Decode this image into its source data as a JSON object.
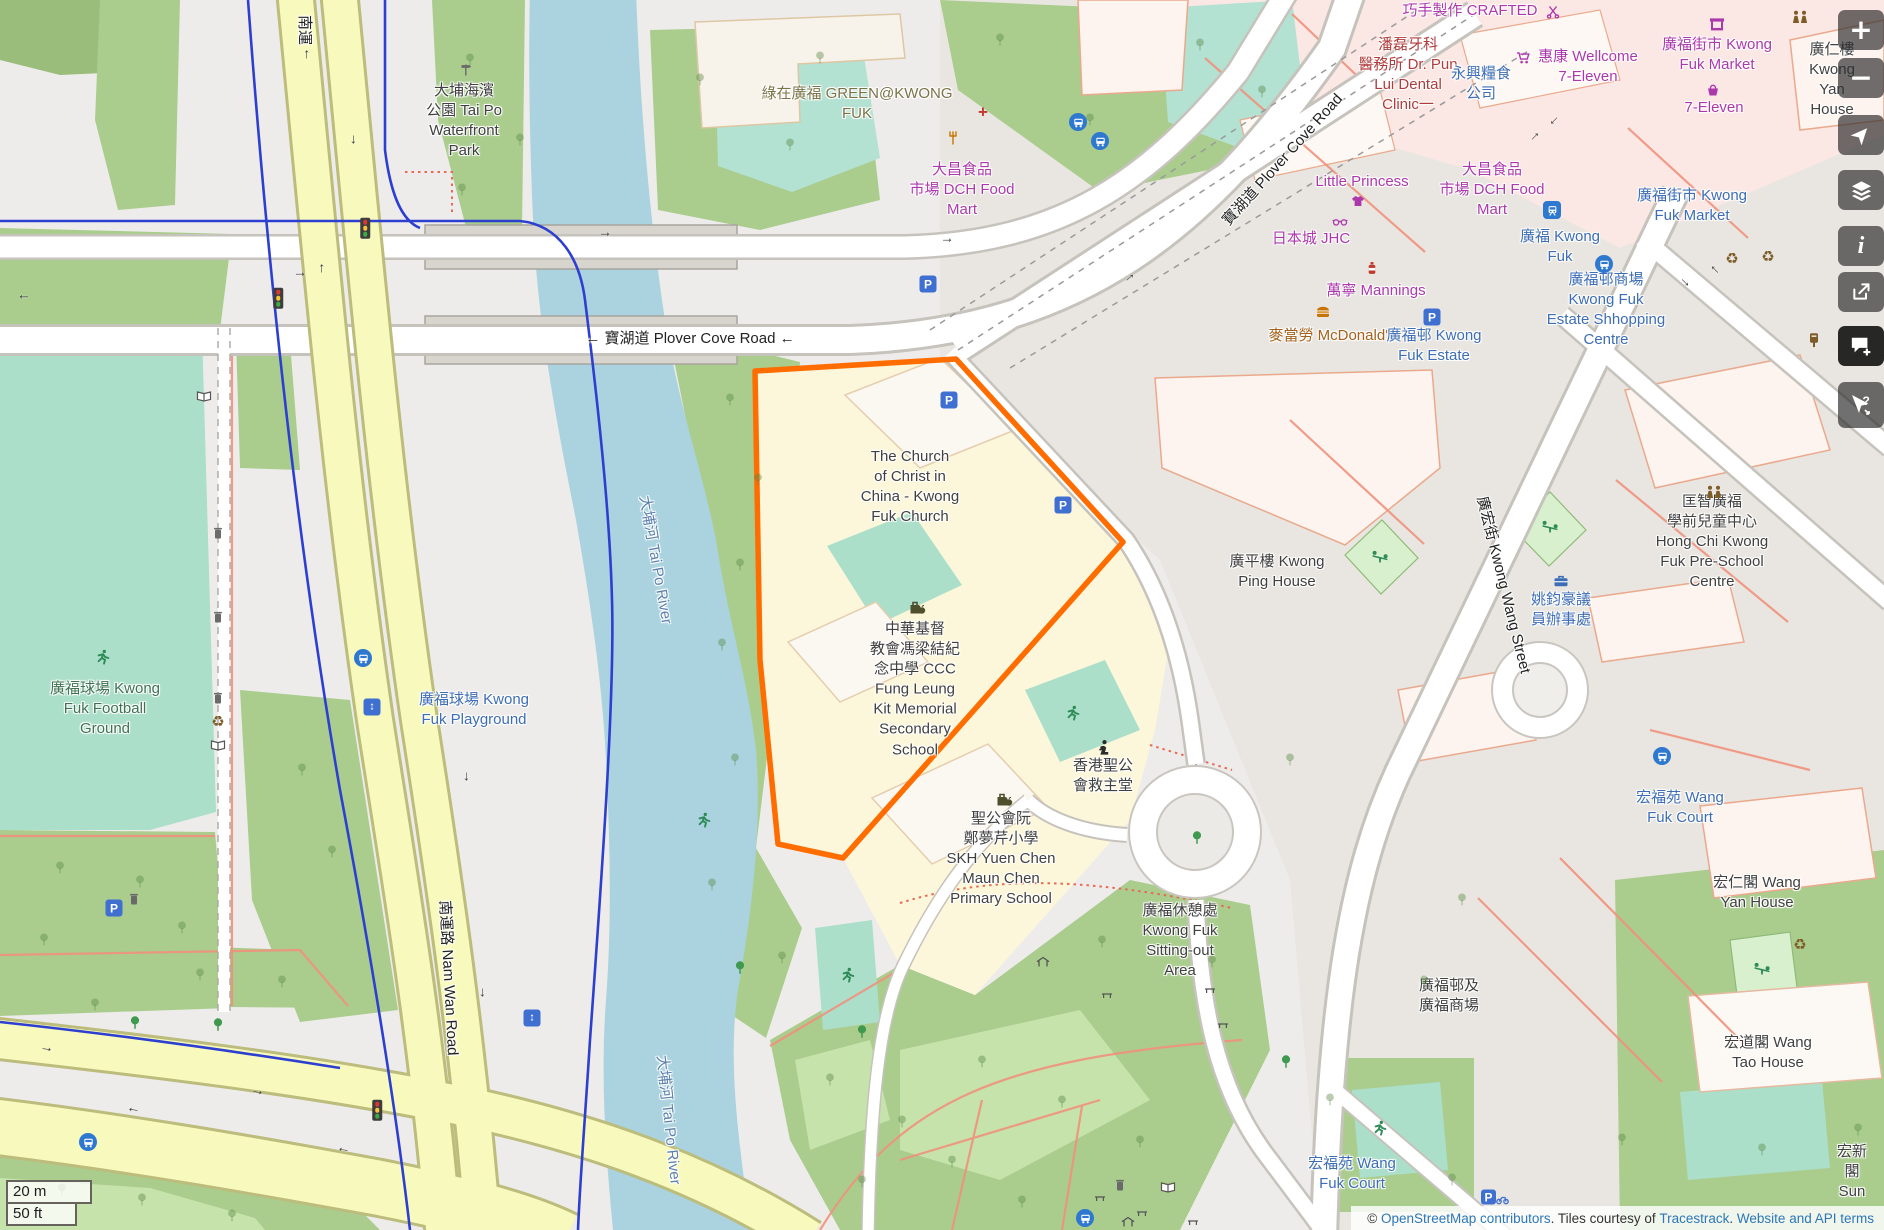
{
  "app": {
    "name": "OpenStreetMap style web map"
  },
  "palette": {
    "dark": "#404040",
    "black": "#222222",
    "blue": "#3d6db4",
    "magenta": "#ac39ac",
    "green": "#3f7252",
    "olive": "#7a7348",
    "red": "#b03c3c",
    "water": "#5d81ad",
    "food": "#a2621c"
  },
  "toolbar": {
    "buttons": [
      {
        "id": "zoom-in",
        "glyph": "+",
        "y": 10
      },
      {
        "id": "zoom-out",
        "glyph": "−",
        "y": 58
      },
      {
        "id": "locate",
        "y": 115
      },
      {
        "id": "layers",
        "y": 170
      },
      {
        "id": "info",
        "glyph": "i",
        "y": 226
      },
      {
        "id": "share",
        "y": 272
      },
      {
        "id": "add-note",
        "y": 326,
        "active": true
      },
      {
        "id": "query-features",
        "y": 382
      }
    ]
  },
  "scalebar": {
    "metric": "20 m",
    "imperial": "50 ft"
  },
  "attribution": {
    "parts": [
      {
        "text": "© ",
        "link": false
      },
      {
        "text": "OpenStreetMap contributors",
        "link": true
      },
      {
        "text": ". Tiles courtesy of ",
        "link": false
      },
      {
        "text": "Tracestrack",
        "link": true
      },
      {
        "text": ". ",
        "link": false
      },
      {
        "text": "Website and API terms",
        "link": true
      }
    ]
  },
  "map": {
    "highlight_color": "#ff6d00",
    "labels": [
      {
        "t": "南運",
        "x": 304,
        "y": 30,
        "c": "black",
        "r": 90
      },
      {
        "t": "大埔海濱\n公園 Tai Po\nWaterfront\nPark",
        "x": 464,
        "y": 121
      },
      {
        "t": "綠在廣福 GREEN@KWONG\nFUK",
        "x": 857,
        "y": 104,
        "c": "olive"
      },
      {
        "t": "← 寶湖道 Plover Cove Road ←",
        "x": 690,
        "y": 339,
        "c": "black"
      },
      {
        "t": "寶湖道 Plover Cove Road",
        "x": 1283,
        "y": 160,
        "c": "black",
        "r": -48
      },
      {
        "t": "大埔河 Tai Po River",
        "x": 655,
        "y": 560,
        "c": "water",
        "r": 80
      },
      {
        "t": "大埔河 Tai Po River",
        "x": 668,
        "y": 1120,
        "c": "water",
        "r": 84
      },
      {
        "t": "廣福球場 Kwong\nFuk Football\nGround",
        "x": 105,
        "y": 709,
        "c": "green"
      },
      {
        "t": "廣福球場 Kwong\nFuk Playground",
        "x": 474,
        "y": 710,
        "c": "blue"
      },
      {
        "t": "南運路 Nam Wan Road",
        "x": 448,
        "y": 978,
        "c": "black",
        "r": 87
      },
      {
        "t": "The Church\nof Christ in\nChina - Kwong\nFuk Church",
        "x": 910,
        "y": 487
      },
      {
        "t": "中華基督\n教會馮梁結紀\n念中學 CCC\nFung Leung\nKit Memorial\nSecondary\nSchool",
        "x": 915,
        "y": 690
      },
      {
        "t": "聖公會阮\n鄭夢芹小學\nSKH Yuen Chen\nMaun Chen\nPrimary School",
        "x": 1001,
        "y": 859
      },
      {
        "t": "香港聖公\n會救主堂",
        "x": 1103,
        "y": 776
      },
      {
        "t": "廣福休憩處\nKwong Fuk\nSitting-out\nArea",
        "x": 1180,
        "y": 941
      },
      {
        "t": "廣平樓 Kwong\nPing House",
        "x": 1277,
        "y": 572
      },
      {
        "t": "匡智廣福\n學前兒童中心\nHong Chi Kwong\nFuk Pre-School\nCentre",
        "x": 1712,
        "y": 542
      },
      {
        "t": "姚鈞豪議\n員辦事處",
        "x": 1561,
        "y": 610,
        "c": "blue"
      },
      {
        "t": "廣宏街 Kwong Wang Street",
        "x": 1503,
        "y": 585,
        "c": "black",
        "r": 76
      },
      {
        "t": "宏福苑 Wang\nFuk Court",
        "x": 1680,
        "y": 808,
        "c": "blue"
      },
      {
        "t": "宏仁閣 Wang\nYan House",
        "x": 1757,
        "y": 893
      },
      {
        "t": "宏道閣 Wang\nTao House",
        "x": 1768,
        "y": 1053
      },
      {
        "t": "宏福苑 Wang\nFuk Court",
        "x": 1352,
        "y": 1174,
        "c": "blue"
      },
      {
        "t": "宏新閣\nSun",
        "x": 1852,
        "y": 1172
      },
      {
        "t": "廣福街市 Kwong\nFuk Market",
        "x": 1717,
        "y": 55,
        "c": "magenta"
      },
      {
        "t": "廣仁樓 Kwong\nYan House",
        "x": 1832,
        "y": 80
      },
      {
        "t": "惠康 Wellcome\n7-Eleven",
        "x": 1588,
        "y": 67,
        "c": "magenta"
      },
      {
        "t": "7-Eleven",
        "x": 1714,
        "y": 108,
        "c": "magenta"
      },
      {
        "t": "巧手製作 CRAFTED",
        "x": 1470,
        "y": 11,
        "c": "magenta"
      },
      {
        "t": "潘磊牙科\n醫務所 Dr. Pun\nLui Dental\nClinic一",
        "x": 1408,
        "y": 75,
        "c": "red"
      },
      {
        "t": "永興糧食\n公司",
        "x": 1481,
        "y": 84,
        "c": "blue"
      },
      {
        "t": "Little Princess",
        "x": 1362,
        "y": 182,
        "c": "magenta"
      },
      {
        "t": "日本城 JHC",
        "x": 1311,
        "y": 239,
        "c": "magenta"
      },
      {
        "t": "大昌食品\n市場 DCH Food\nMart",
        "x": 962,
        "y": 190,
        "c": "magenta"
      },
      {
        "t": "大昌食品\n市場 DCH Food\nMart",
        "x": 1492,
        "y": 190,
        "c": "magenta"
      },
      {
        "t": "萬寧 Mannings",
        "x": 1376,
        "y": 291,
        "c": "magenta"
      },
      {
        "t": "麥當勞 McDonald's",
        "x": 1332,
        "y": 336,
        "c": "food"
      },
      {
        "t": "廣福邨 Kwong\nFuk Estate",
        "x": 1434,
        "y": 346,
        "c": "blue"
      },
      {
        "t": "廣福街市 Kwong\nFuk Market",
        "x": 1692,
        "y": 206,
        "c": "blue"
      },
      {
        "t": "廣福 Kwong\nFuk",
        "x": 1560,
        "y": 247,
        "c": "blue"
      },
      {
        "t": "廣福邨商場\nKwong Fuk\nEstate Shhopping\nCentre",
        "x": 1606,
        "y": 310,
        "c": "blue"
      },
      {
        "t": "廣福邨及\n廣福商場",
        "x": 1449,
        "y": 996
      }
    ],
    "icons": [
      {
        "k": "parking",
        "x": 949,
        "y": 400
      },
      {
        "k": "parking",
        "x": 1063,
        "y": 505
      },
      {
        "k": "parking",
        "x": 1432,
        "y": 317
      },
      {
        "k": "parking",
        "x": 928,
        "y": 284
      },
      {
        "k": "parking",
        "x": 114,
        "y": 908
      },
      {
        "k": "parkingbike",
        "x": 1495,
        "y": 1197
      },
      {
        "k": "bus",
        "x": 1078,
        "y": 122
      },
      {
        "k": "bus",
        "x": 1100,
        "y": 141
      },
      {
        "k": "bus",
        "x": 363,
        "y": 658
      },
      {
        "k": "bus",
        "x": 88,
        "y": 1142
      },
      {
        "k": "bus",
        "x": 1085,
        "y": 1218
      },
      {
        "k": "bus",
        "x": 1662,
        "y": 756
      },
      {
        "k": "bus",
        "x": 1604,
        "y": 264
      },
      {
        "k": "rail",
        "x": 1552,
        "y": 210
      },
      {
        "k": "elevator",
        "x": 372,
        "y": 707
      },
      {
        "k": "elevator",
        "x": 532,
        "y": 1018
      },
      {
        "k": "trafficlight",
        "x": 365,
        "y": 228
      },
      {
        "k": "trafficlight",
        "x": 278,
        "y": 298
      },
      {
        "k": "trafficlight",
        "x": 377,
        "y": 1110
      },
      {
        "k": "school",
        "x": 917,
        "y": 607
      },
      {
        "k": "school",
        "x": 1004,
        "y": 799
      },
      {
        "k": "worship",
        "x": 1103,
        "y": 748
      },
      {
        "k": "runner",
        "x": 103,
        "y": 657
      },
      {
        "k": "runner",
        "x": 1073,
        "y": 713
      },
      {
        "k": "runner",
        "x": 704,
        "y": 820
      },
      {
        "k": "runner",
        "x": 848,
        "y": 975
      },
      {
        "k": "runner",
        "x": 1380,
        "y": 1128
      },
      {
        "k": "seesaw",
        "x": 1380,
        "y": 556
      },
      {
        "k": "seesaw",
        "x": 1550,
        "y": 526
      },
      {
        "k": "seesaw",
        "x": 1762,
        "y": 968
      },
      {
        "k": "people",
        "x": 1800,
        "y": 17
      },
      {
        "k": "people",
        "x": 1714,
        "y": 492
      },
      {
        "k": "recycle",
        "x": 218,
        "y": 722
      },
      {
        "k": "recycle",
        "x": 1732,
        "y": 259
      },
      {
        "k": "recycle",
        "x": 1768,
        "y": 257
      },
      {
        "k": "recycle",
        "x": 1800,
        "y": 945
      },
      {
        "k": "postbox",
        "x": 1814,
        "y": 340
      },
      {
        "k": "trash",
        "x": 218,
        "y": 533
      },
      {
        "k": "trash",
        "x": 218,
        "y": 617
      },
      {
        "k": "trash",
        "x": 218,
        "y": 698
      },
      {
        "k": "trash",
        "x": 134,
        "y": 899
      },
      {
        "k": "trash",
        "x": 1120,
        "y": 1185
      },
      {
        "k": "mapboard",
        "x": 218,
        "y": 745
      },
      {
        "k": "mapboard",
        "x": 204,
        "y": 396
      },
      {
        "k": "mapboard",
        "x": 1168,
        "y": 1187
      },
      {
        "k": "burger",
        "x": 1323,
        "y": 312
      },
      {
        "k": "fork",
        "x": 953,
        "y": 138
      },
      {
        "k": "medical",
        "x": 983,
        "y": 112
      },
      {
        "k": "bottle",
        "x": 1372,
        "y": 268
      },
      {
        "k": "stall",
        "x": 1717,
        "y": 24
      },
      {
        "k": "basket",
        "x": 1713,
        "y": 90
      },
      {
        "k": "cart",
        "x": 1523,
        "y": 58
      },
      {
        "k": "scissors",
        "x": 1553,
        "y": 12
      },
      {
        "k": "briefcase",
        "x": 1561,
        "y": 581
      },
      {
        "k": "shelter",
        "x": 1043,
        "y": 962
      },
      {
        "k": "shelter",
        "x": 1128,
        "y": 1222
      },
      {
        "k": "bench",
        "x": 1107,
        "y": 995
      },
      {
        "k": "bench",
        "x": 1210,
        "y": 990
      },
      {
        "k": "bench",
        "x": 1223,
        "y": 1025
      },
      {
        "k": "bench",
        "x": 1100,
        "y": 1198
      },
      {
        "k": "bench",
        "x": 1142,
        "y": 1213
      },
      {
        "k": "bench",
        "x": 1193,
        "y": 1222
      },
      {
        "k": "shirt",
        "x": 1358,
        "y": 201
      },
      {
        "k": "glasses",
        "x": 1340,
        "y": 222
      },
      {
        "k": "signpost",
        "x": 466,
        "y": 70
      }
    ],
    "trees": [
      [
        470,
        60
      ],
      [
        520,
        140
      ],
      [
        462,
        190
      ],
      [
        700,
        80
      ],
      [
        820,
        58
      ],
      [
        790,
        145
      ],
      [
        1000,
        40
      ],
      [
        1090,
        120
      ],
      [
        1200,
        45
      ],
      [
        1262,
        92
      ],
      [
        730,
        400
      ],
      [
        758,
        480
      ],
      [
        740,
        565
      ],
      [
        722,
        645
      ],
      [
        735,
        760
      ],
      [
        712,
        885
      ],
      [
        782,
        958
      ],
      [
        60,
        868
      ],
      [
        140,
        882
      ],
      [
        44,
        940
      ],
      [
        182,
        928
      ],
      [
        95,
        1005
      ],
      [
        200,
        975
      ],
      [
        282,
        982
      ],
      [
        62,
        1190
      ],
      [
        142,
        1200
      ],
      [
        232,
        1216
      ],
      [
        302,
        770
      ],
      [
        332,
        852
      ],
      [
        830,
        1080
      ],
      [
        902,
        1122
      ],
      [
        982,
        1062
      ],
      [
        1062,
        1102
      ],
      [
        1140,
        1142
      ],
      [
        1212,
        962
      ],
      [
        1102,
        942
      ],
      [
        952,
        1162
      ],
      [
        862,
        1182
      ],
      [
        1022,
        1202
      ],
      [
        1290,
        760
      ],
      [
        1462,
        900
      ],
      [
        1424,
        982
      ],
      [
        1622,
        1140
      ],
      [
        1858,
        1130
      ],
      [
        1762,
        1150
      ],
      [
        1330,
        1100
      ],
      [
        1452,
        1180
      ]
    ],
    "solid_trees": [
      [
        135,
        1023
      ],
      [
        218,
        1025
      ],
      [
        740,
        968
      ],
      [
        1197,
        838
      ],
      [
        862,
        1032
      ],
      [
        1286,
        1062
      ]
    ],
    "arrows": [
      [
        300,
        272,
        0
      ],
      [
        24,
        300,
        180
      ],
      [
        947,
        238,
        0
      ],
      [
        1128,
        276,
        -40
      ],
      [
        605,
        232,
        0
      ],
      [
        304,
        55,
        -90
      ],
      [
        356,
        140,
        90
      ],
      [
        319,
        269,
        -90
      ],
      [
        469,
        777,
        90
      ],
      [
        443,
        906,
        180
      ],
      [
        485,
        993,
        90
      ],
      [
        47,
        1047,
        8
      ],
      [
        258,
        1090,
        10
      ],
      [
        133,
        1113,
        188
      ],
      [
        343,
        1153,
        190
      ],
      [
        1556,
        123,
        135
      ],
      [
        1533,
        135,
        -45
      ],
      [
        1687,
        281,
        45
      ],
      [
        1713,
        272,
        -135
      ]
    ]
  }
}
